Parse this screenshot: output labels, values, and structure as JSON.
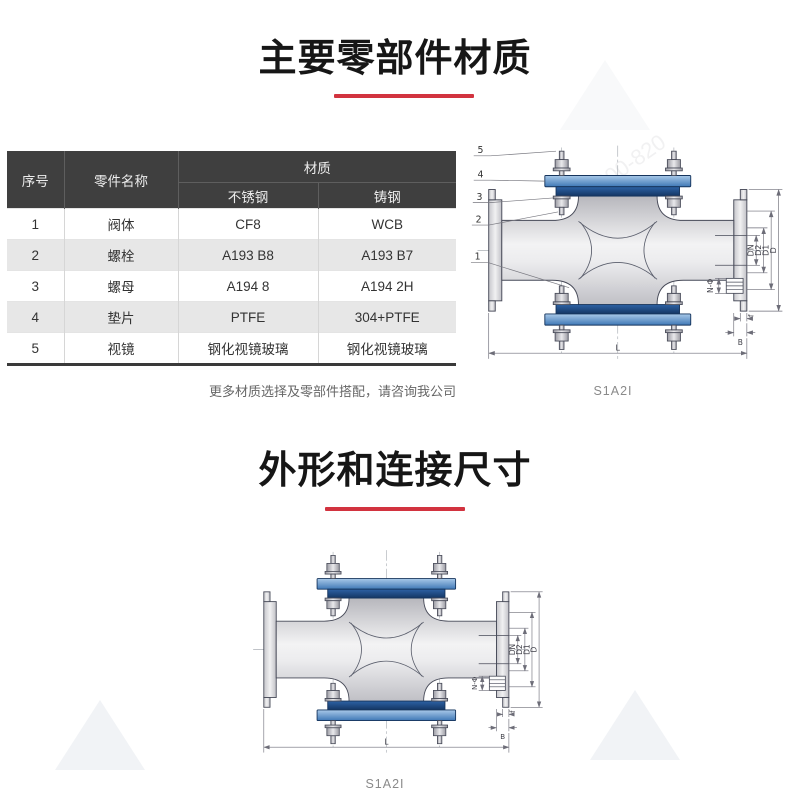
{
  "colors": {
    "accent_red": "#d2333f",
    "table_header_bg": "#3f3f3f",
    "table_row_alt_bg": "#e7e7e7",
    "flange_blue": "#1d4f8f"
  },
  "section1": {
    "title": "主要零部件材质"
  },
  "section2": {
    "title": "外形和连接尺寸"
  },
  "table": {
    "headers": {
      "col_no": "序号",
      "col_part": "零件名称",
      "col_material": "材质",
      "sub_stainless": "不锈钢",
      "sub_cast": "铸钢"
    },
    "rows": [
      {
        "no": "1",
        "part": "阀体",
        "stainless": "CF8",
        "cast": "WCB"
      },
      {
        "no": "2",
        "part": "螺栓",
        "stainless": "A193 B8",
        "cast": "A193 B7"
      },
      {
        "no": "3",
        "part": "螺母",
        "stainless": "A194 8",
        "cast": "A194 2H"
      },
      {
        "no": "4",
        "part": "垫片",
        "stainless": "PTFE",
        "cast": "304+PTFE"
      },
      {
        "no": "5",
        "part": "视镜",
        "stainless": "钢化视镜玻璃",
        "cast": "钢化视镜玻璃"
      }
    ],
    "note": "更多材质选择及零部件搭配，请咨询我公司"
  },
  "drawing": {
    "dims": {
      "dn": "DN",
      "d2": "D2",
      "d1": "D1",
      "d": "D",
      "n_phi": "N-Φ",
      "f": "f",
      "b": "B",
      "l": "L"
    }
  },
  "drawing1": {
    "caption": "S1A2I",
    "callouts": [
      "5",
      "4",
      "3",
      "2",
      "1"
    ]
  },
  "drawing2": {
    "caption": "S1A2I"
  },
  "watermark": {
    "text": "800-820"
  }
}
